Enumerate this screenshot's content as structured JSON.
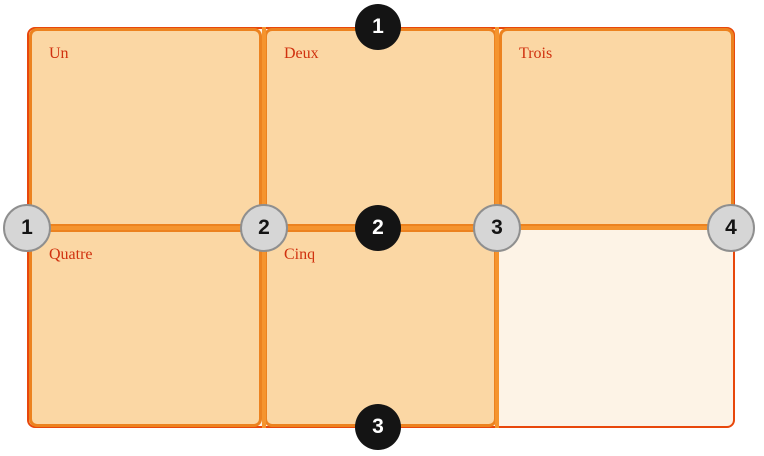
{
  "diagram": {
    "description": "CSS grid diagram with numbered row and column lines",
    "cells": [
      {
        "label": "Un"
      },
      {
        "label": "Deux"
      },
      {
        "label": "Trois"
      },
      {
        "label": "Quatre"
      },
      {
        "label": "Cinq"
      }
    ],
    "row_line_markers": [
      "1",
      "2",
      "3"
    ],
    "column_line_markers": [
      "1",
      "2",
      "3",
      "4"
    ],
    "colors": {
      "cell_fill": "#fbd7a4",
      "cell_border": "#ec821f",
      "grid_background": "#fdf3e6",
      "grid_border": "#e8470b",
      "grid_line": "#f5942e",
      "label_text": "#d0310f",
      "row_marker_fill": "#141414",
      "row_marker_text": "#ffffff",
      "column_marker_fill": "#d6d6d6",
      "column_marker_border": "#8f8f8f",
      "column_marker_text": "#141414"
    }
  }
}
